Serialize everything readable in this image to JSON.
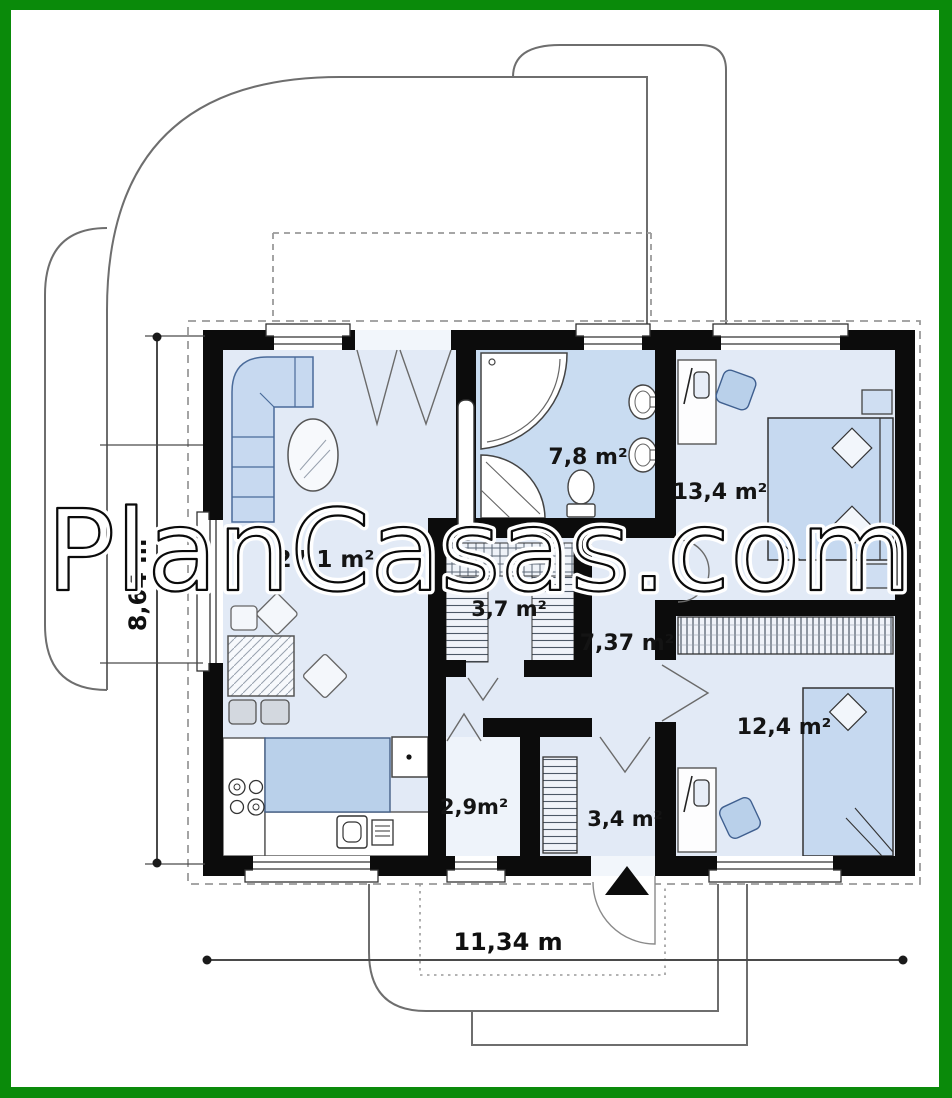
{
  "watermark": "PlanCasas.com",
  "rooms": {
    "living": "27,1 m²",
    "bathroom": "7,8 m²",
    "bedroom_top": "13,4 m²",
    "wardrobe": "3,7 m²",
    "hallway": "7,37 m²",
    "wc": "2,9m²",
    "entry": "3,4 m²",
    "bedroom_bottom": "12,4 m²"
  },
  "dimensions": {
    "horizontal": "11,34 m",
    "vertical": "8,64 m"
  },
  "colors": {
    "frame": "#0a8a0a",
    "floor": "#e2eaf6",
    "bathroom_floor": "#c9dcf1",
    "wc_floor": "#eef3fa",
    "furniture_blue": "#b9d0ea",
    "wall": "#0c0c0c"
  }
}
